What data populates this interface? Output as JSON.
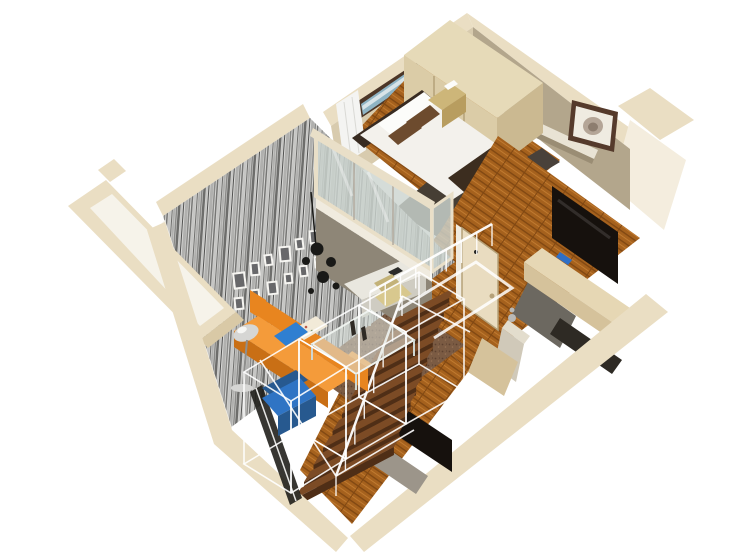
{
  "meta": {
    "title": "3D cutaway axonometric render of a small loft apartment floor plan",
    "render_type": "isometric-3d-floorplan",
    "background": "#ffffff"
  },
  "rooms": [
    {
      "name": "loft-bedroom"
    },
    {
      "name": "hallway"
    },
    {
      "name": "living-room-double-height"
    },
    {
      "name": "staircase"
    },
    {
      "name": "entry"
    },
    {
      "name": "lower-level"
    }
  ],
  "objects": [
    {
      "name": "wardrobe"
    },
    {
      "name": "double-bed"
    },
    {
      "name": "bed-runner"
    },
    {
      "name": "bed-bench"
    },
    {
      "name": "nightstand"
    },
    {
      "name": "headboard-art-strip"
    },
    {
      "name": "curtain"
    },
    {
      "name": "flower-wall-art"
    },
    {
      "name": "floating-shelf"
    },
    {
      "name": "wall-mounted-tv"
    },
    {
      "name": "storage-console"
    },
    {
      "name": "entry-door"
    },
    {
      "name": "mezzanine-glass-balustrade"
    },
    {
      "name": "desk-nook"
    },
    {
      "name": "desk-chair"
    },
    {
      "name": "striped-feature-wall"
    },
    {
      "name": "picture-frame-gallery"
    },
    {
      "name": "black-pendant-lamp"
    },
    {
      "name": "orange-sofa"
    },
    {
      "name": "floor-lamp"
    },
    {
      "name": "glass-coffee-table"
    },
    {
      "name": "area-rug"
    },
    {
      "name": "blue-armchair"
    },
    {
      "name": "glass-partition-wireframes"
    },
    {
      "name": "wood-staircase"
    },
    {
      "name": "white-stair-railing"
    },
    {
      "name": "lower-level-tv"
    },
    {
      "name": "tv-stand"
    },
    {
      "name": "gray-cabinet"
    },
    {
      "name": "pedestal-sculpture"
    },
    {
      "name": "window-pane"
    },
    {
      "name": "balcony-bay"
    }
  ],
  "palette": {
    "bg": "#ffffff",
    "cut_top": "#eadec3",
    "cut_shadow": "#d9c9a6",
    "wall_outer": "#f4edde",
    "bedroom_wall": "#d8cbae",
    "hall_wall": "#b3a68c",
    "white_wall": "#f3f0e8",
    "bay_inner": "#f6f3ea",
    "trim_wood": "#6e4a33",
    "art_frame": "#4c3627",
    "art_teal": "#8fb4c4",
    "art_light": "#d8e4e8",
    "flower_frame": "#553a2b",
    "flower_mat": "#efebe1",
    "flower_bloom": "#b4a597",
    "flower_core": "#8d7d6f",
    "shelf_light": "#e9e3d4",
    "shelf_shadow": "#9a8d74",
    "wood_base": "#a5611d",
    "wood_dark": "#814812",
    "wood_light": "#c07a30",
    "dark_rug": "#463e34",
    "rug_base": "#7b5b43",
    "rug_dot1": "#5d4130",
    "rug_dot2": "#977254",
    "stripe1": "#6d6d6b",
    "stripe2": "#c6c6c4",
    "stripe3": "#515150",
    "stripe4": "#b0b0ae",
    "stripe5": "#8a8a88",
    "stripe6": "#d8d8d6",
    "stripe7": "#767674",
    "wardrobe_top": "#e6dab8",
    "wardrobe_front": "#dbcca7",
    "wardrobe_side": "#cbb991",
    "seam": "#a08d62",
    "curtain": "#f4f4f2",
    "headboard": "#382b21",
    "mattress": "#f3f1ec",
    "pillow_white": "#fcfcfa",
    "pillow_brown": "#6d4b2e",
    "runner": "#3c2d1f",
    "bench": "#49413a",
    "gold": "#cdb679",
    "gold_dark": "#b89d5f",
    "tv_black": "#16110d",
    "console_top": "#e6d7b4",
    "console_front": "#d5c29b",
    "compartment_dark": "#2e2a24",
    "phone_blue": "#2f6fc6",
    "door": "#e9dcc0",
    "door_edge": "#b5a179",
    "glass": "#ccd4cf",
    "glass_frame": "#e9dfc8",
    "mullion": "#b4aca0",
    "slab_white": "#f0ebdf",
    "nook_shadow": "#8e8677",
    "desk_top": "#e9e7df",
    "desk_front": "#cfccc2",
    "chair_tan": "#d8c88e",
    "chair_tan_dark": "#c3b278",
    "laptop_dark": "#2b2b29",
    "stair_top": "#7c4b25",
    "stair_front": "#4f2e16",
    "rail_white": "#ffffff",
    "tv_stand": "#9c958a",
    "gray_panel": "#6c6860",
    "pedestal": "#d0c9b9",
    "pedestal_top": "#e3ddcd",
    "silver": "#b9b9b7",
    "sofa_orange": "#e8851f",
    "sofa_orange_light": "#f49b3a",
    "sofa_orange_dark": "#c96f15",
    "pillow_blue": "#2f7fd1",
    "pillow_floral": "#f2ead8",
    "lamp_chrome": "#d6d6d4",
    "lamp_dark": "#8e8e8c",
    "pendant_black": "#191917",
    "table_glass": "#dce4de",
    "chair_blue": "#2f74c4",
    "chair_blue_dark": "#27598f",
    "window_black": "#1b1a16",
    "chrome_line": "#e6e6e4",
    "frame_white": "#f6f5f1",
    "frame_inner": "#68686a",
    "figurine_dark": "#2f2a24"
  },
  "gallery_frames": [
    [
      233,
      272,
      13,
      17,
      -7
    ],
    [
      250,
      262,
      10,
      14,
      -5
    ],
    [
      264,
      254,
      9,
      12,
      -7
    ],
    [
      279,
      246,
      12,
      16,
      -5
    ],
    [
      295,
      238,
      9,
      12,
      -7
    ],
    [
      309,
      230,
      10,
      14,
      -5
    ],
    [
      234,
      297,
      10,
      13,
      -6
    ],
    [
      251,
      289,
      9,
      11,
      -6
    ],
    [
      267,
      281,
      11,
      14,
      -6
    ],
    [
      284,
      273,
      9,
      11,
      -6
    ],
    [
      299,
      265,
      9,
      12,
      -6
    ],
    [
      314,
      256,
      9,
      12,
      -6
    ],
    [
      325,
      241,
      12,
      16,
      -6
    ]
  ],
  "pendant": {
    "stem": [
      311,
      192,
      316,
      247
    ],
    "balls": [
      [
        317,
        249,
        6.5
      ],
      [
        331,
        262,
        5
      ],
      [
        306,
        261,
        4
      ],
      [
        323,
        277,
        6
      ],
      [
        336,
        286,
        3.5
      ],
      [
        311,
        291,
        3
      ]
    ]
  },
  "stairs": {
    "count": 11,
    "x0": 396,
    "y0": 318,
    "dx": -9.5,
    "dy": 17,
    "len0": 68,
    "dlen": 4.5,
    "ux": 0.88,
    "uy": -0.46,
    "wx": -6.5,
    "wy": 11,
    "lip": 8
  },
  "stair_rail": {
    "x1": 402,
    "y1": 296,
    "x2": 336,
    "y2": 476,
    "posts": 7,
    "post_h": 20
  },
  "hall_rail": {
    "x1": 370,
    "y1": 292,
    "x2": 492,
    "y2": 224,
    "posts": 8,
    "post_h": 22
  },
  "landing_trim": [
    [
      398,
      310
    ],
    [
      476,
      262
    ],
    [
      512,
      288
    ],
    [
      434,
      338
    ]
  ],
  "wireframe_boxes": [
    {
      "top": [
        [
          244,
          372
        ],
        [
          299,
          339
        ],
        [
          346,
          367
        ],
        [
          291,
          401
        ]
      ],
      "drop": 92
    },
    {
      "top": [
        [
          299,
          339
        ],
        [
          359,
          305
        ],
        [
          406,
          332
        ],
        [
          346,
          367
        ]
      ],
      "drop": 92
    },
    {
      "top": [
        [
          359,
          305
        ],
        [
          419,
          272
        ],
        [
          464,
          299
        ],
        [
          406,
          332
        ]
      ],
      "drop": 92
    }
  ],
  "wireframe_lines": [
    [
      336,
      476,
      414,
      430
    ],
    [
      402,
      296,
      470,
      332
    ],
    [
      260,
      360,
      336,
      476
    ],
    [
      291,
      401,
      291,
      493
    ]
  ]
}
